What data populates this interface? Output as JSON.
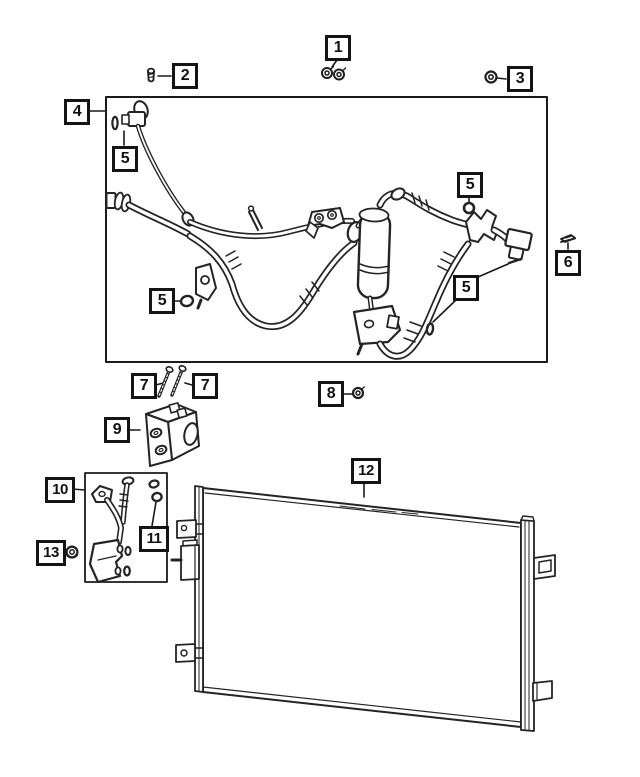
{
  "page": {
    "background": "#ffffff",
    "line_color": "#231f20"
  },
  "callouts": {
    "c1": {
      "label": "1"
    },
    "c2": {
      "label": "2"
    },
    "c3": {
      "label": "3"
    },
    "c4": {
      "label": "4"
    },
    "c5a": {
      "label": "5"
    },
    "c5b": {
      "label": "5"
    },
    "c5c": {
      "label": "5"
    },
    "c5d": {
      "label": "5"
    },
    "c6": {
      "label": "6"
    },
    "c7a": {
      "label": "7"
    },
    "c7b": {
      "label": "7"
    },
    "c8": {
      "label": "8"
    },
    "c9": {
      "label": "9"
    },
    "c10": {
      "label": "10"
    },
    "c11": {
      "label": "11"
    },
    "c12": {
      "label": "12"
    },
    "c13": {
      "label": "13"
    }
  }
}
